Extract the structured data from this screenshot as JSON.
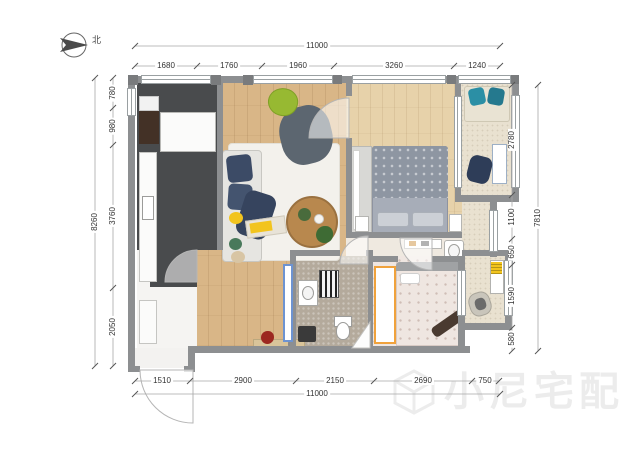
{
  "north": {
    "label": "北"
  },
  "watermark": {
    "text": "小尼宅配"
  },
  "dims": {
    "top": {
      "overall": "11000",
      "segments": [
        "1680",
        "1760",
        "1960",
        "3260",
        "1240"
      ]
    },
    "bottom": {
      "overall": "11000",
      "segments": [
        "1510",
        "2900",
        "2150",
        "2690",
        "750"
      ]
    },
    "left": {
      "overall": "8260",
      "segments": [
        "780",
        "980",
        "3760",
        "2050"
      ]
    },
    "right": {
      "overall": "7810",
      "segments": [
        "2780",
        "1100",
        "650",
        "1590",
        "580"
      ]
    }
  },
  "palette": {
    "wall_gray": "#8d8f91",
    "living_wood": "#d9b687",
    "bedroom_wood": "#e7d2aa",
    "kitchen_dark": "#494b4d",
    "bathroom_tile": "#b4aa9c",
    "balcony_tile": "#e9e1d0",
    "rug_white": "#f3f1ec",
    "sofa_navy": "#3c4b66",
    "accent_yellow": "#f2c41e",
    "accent_green": "#97b932",
    "accent_teal": "#2b8fa5",
    "accent_orange": "#f0a23c",
    "accent_blue": "#6d93d1",
    "bed_gray": "#97a0ac",
    "bed_pink": "#efe6e1",
    "flower_red": "#9c2720"
  }
}
